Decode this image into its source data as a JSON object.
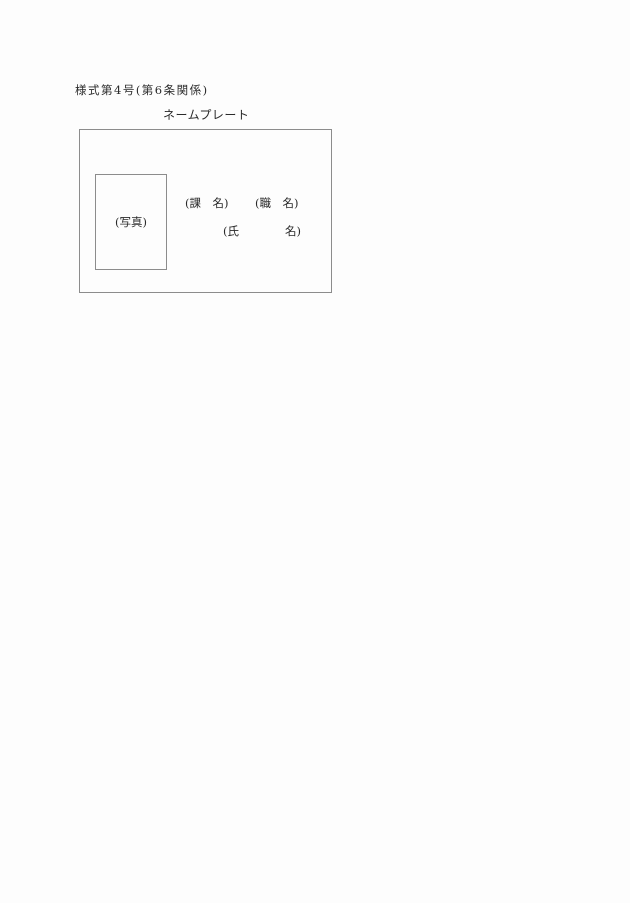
{
  "page": {
    "background": "#fdfdfd",
    "text_color": "#2a2a2a",
    "border_color": "#8c8c8c"
  },
  "document": {
    "form_label": "様式第4号(第6条関係)",
    "title": "ネームプレート",
    "nameplate": {
      "photo_label": "(写真)",
      "section_label": "(課　名)",
      "position_label": "(職　名)",
      "name_label": "(氏　　　　名)"
    }
  }
}
